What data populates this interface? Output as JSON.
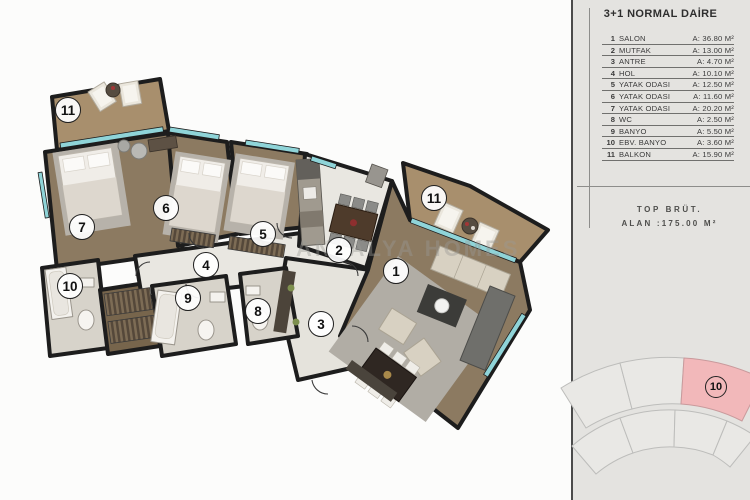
{
  "panel": {
    "title": "3+1 NORMAL DAİRE",
    "rooms": [
      {
        "num": "1",
        "name": "SALON",
        "area": "A: 36.80 M²"
      },
      {
        "num": "2",
        "name": "MUTFAK",
        "area": "A: 13.00 M²"
      },
      {
        "num": "3",
        "name": "ANTRE",
        "area": "A: 4.70 M²"
      },
      {
        "num": "4",
        "name": "HOL",
        "area": "A: 10.10 M²"
      },
      {
        "num": "5",
        "name": "YATAK ODASI",
        "area": "A: 12.50 M²"
      },
      {
        "num": "6",
        "name": "YATAK ODASI",
        "area": "A: 11.60 M²"
      },
      {
        "num": "7",
        "name": "YATAK ODASI",
        "area": "A: 20.20 M²"
      },
      {
        "num": "8",
        "name": "WC",
        "area": "A: 2.50 M²"
      },
      {
        "num": "9",
        "name": "BANYO",
        "area": "A: 5.50 M²"
      },
      {
        "num": "10",
        "name": "EBV. BANYO",
        "area": "A: 3.60 M²"
      },
      {
        "num": "11",
        "name": "BALKON",
        "area": "A: 15.90 M²"
      }
    ],
    "total_line1": "TOP BRÜT.",
    "total_line2": "ALAN :175.00 M²",
    "minimap": {
      "highlighted_unit": "10",
      "highlight_color": "#f2b8ba"
    }
  },
  "plan": {
    "watermark": "ANTALYA HOMES",
    "room_labels": [
      {
        "id": "11",
        "x": 68,
        "y": 110
      },
      {
        "id": "7",
        "x": 82,
        "y": 227
      },
      {
        "id": "10",
        "x": 70,
        "y": 286
      },
      {
        "id": "6",
        "x": 166,
        "y": 208
      },
      {
        "id": "5",
        "x": 263,
        "y": 234
      },
      {
        "id": "4",
        "x": 206,
        "y": 265
      },
      {
        "id": "9",
        "x": 188,
        "y": 298
      },
      {
        "id": "8",
        "x": 258,
        "y": 311
      },
      {
        "id": "2",
        "x": 339,
        "y": 250
      },
      {
        "id": "3",
        "x": 321,
        "y": 324
      },
      {
        "id": "1",
        "x": 396,
        "y": 271
      },
      {
        "id": "11",
        "x": 434,
        "y": 198
      }
    ]
  },
  "colors": {
    "panel_bg": "#e4e3e0",
    "wood_floor": "#8c7a61",
    "balcony_wood": "#a88f6d",
    "tile_floor": "#e9e7e1",
    "bath_floor": "#d7d3ca",
    "wall": "#1d1d1d",
    "window_glass": "#8fd4d8",
    "minimap_highlight": "#f2b8ba"
  }
}
